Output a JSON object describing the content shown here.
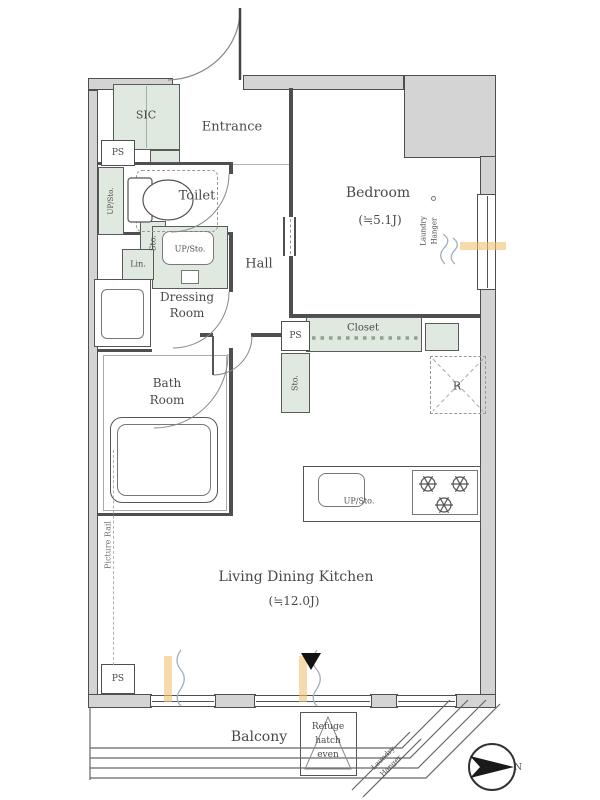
{
  "colors": {
    "storage_fill": "#e0e9e0",
    "wall_fill": "#d4d4d4",
    "wall_line": "#4f4f4f",
    "text": "#4a4a4a",
    "window_accent": "#f0c172",
    "curtain_line": "#a2aebe"
  },
  "rooms": {
    "entrance": "Entrance",
    "sic": "SIC",
    "toilet": "Toilet",
    "hall": "Hall",
    "dressing_line1": "Dressing",
    "dressing_line2": "Room",
    "bath_line1": "Bath",
    "bath_line2": "Room",
    "bedroom": "Bedroom",
    "bedroom_size": "(≒5.1J)",
    "ldk": "Living Dining Kitchen",
    "ldk_size": "(≒12.0J)",
    "balcony": "Balcony"
  },
  "storage": {
    "closet": "Closet",
    "sto": "Sto.",
    "up_sto": "UP/Sto.",
    "lin": "Lin.",
    "ps": "PS",
    "refrigerator": "R"
  },
  "annotations": {
    "laundry_line1": "Laundry",
    "laundry_line2": "Hanger",
    "picture_rail": "Picture Rail",
    "refuge_line1": "Refuge",
    "refuge_line2": "hatch",
    "refuge_line3": "even",
    "north": "N"
  }
}
